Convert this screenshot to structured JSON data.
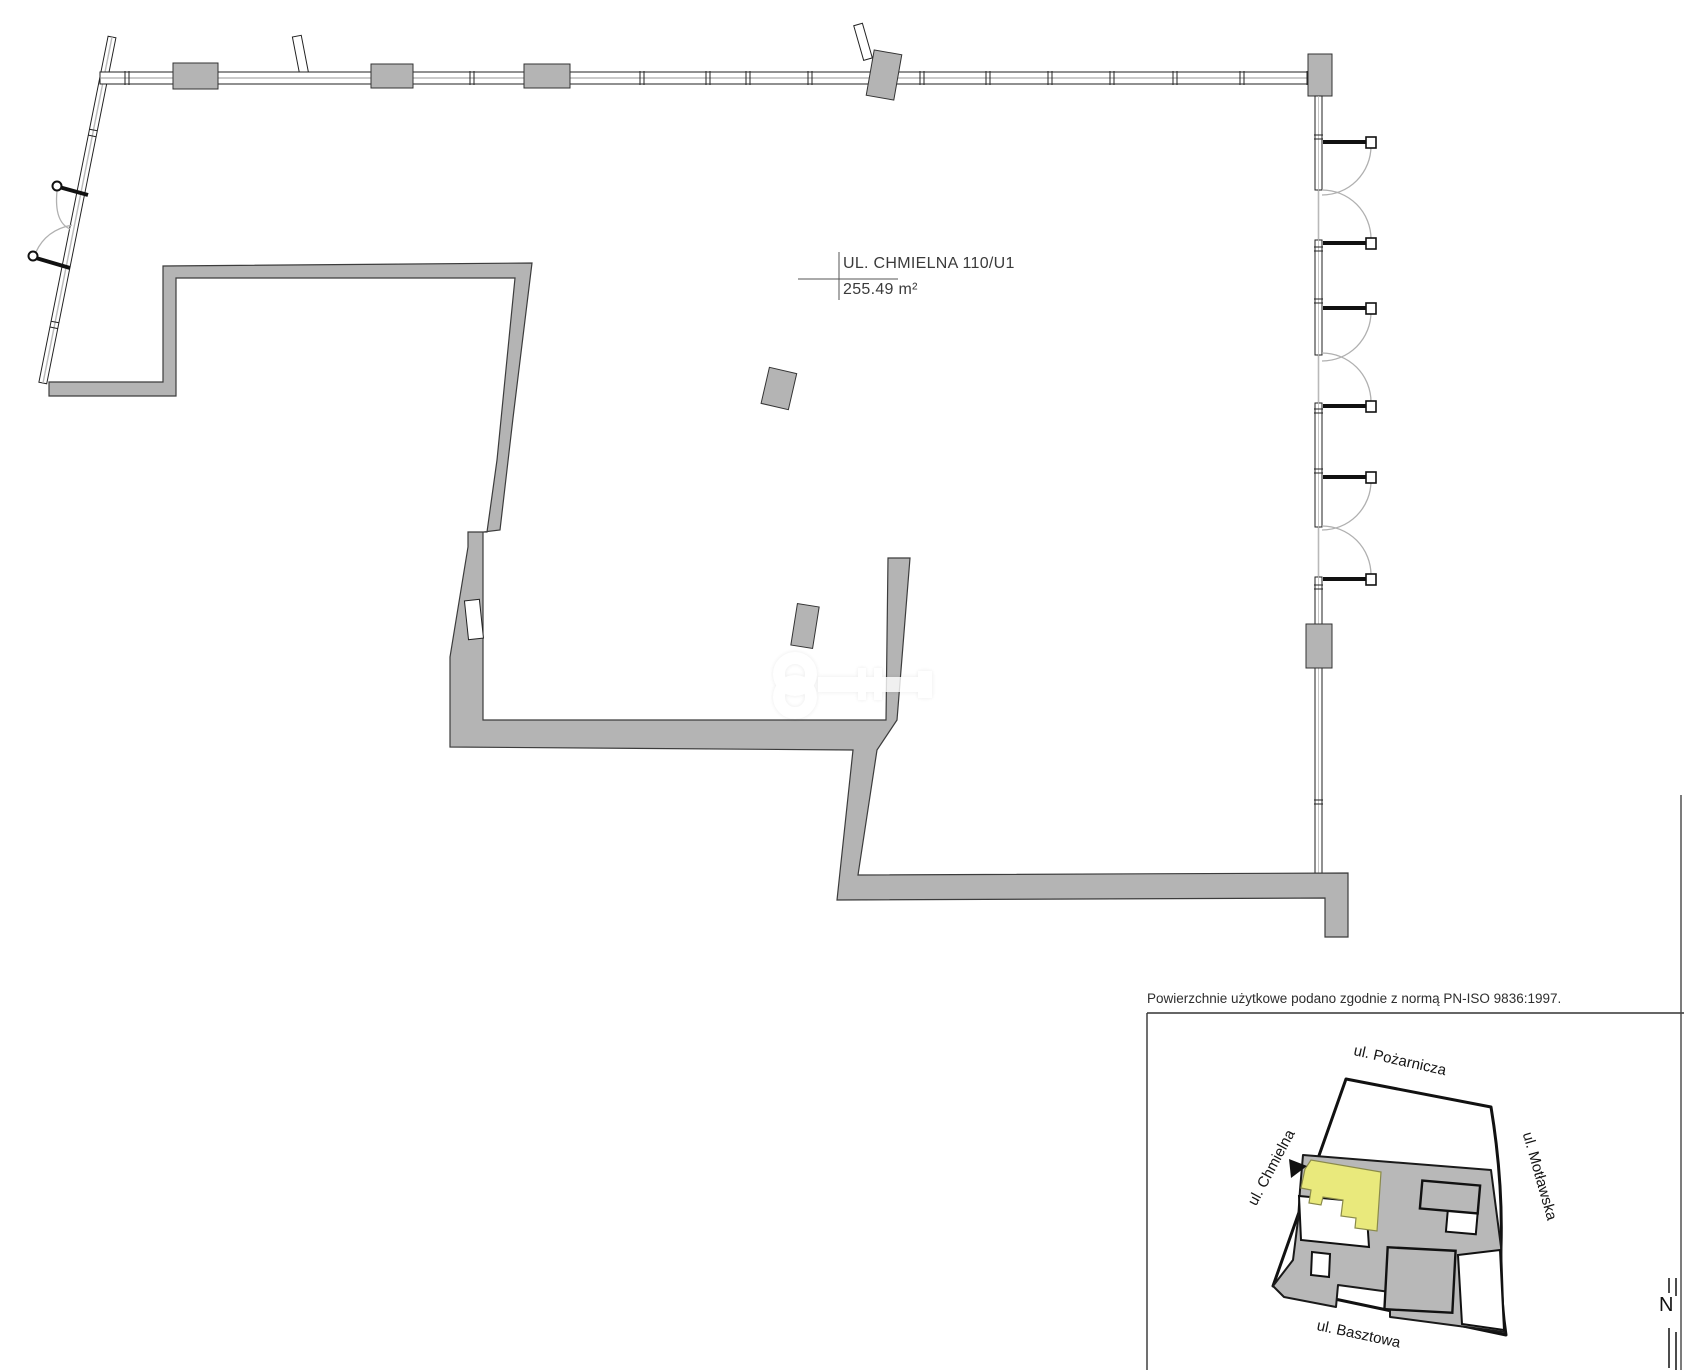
{
  "plan": {
    "unit_label": "UL. CHMIELNA 110/U1",
    "unit_area": "255.49 m²"
  },
  "footer": {
    "norm_note": "Powierzchnie użytkowe podano zgodnie z normą PN-ISO 9836:1997."
  },
  "map": {
    "streets": {
      "top": "ul. Pożarnicza",
      "left": "ul. Chmielna",
      "right": "ul. Motławska",
      "bottom": "ul. Basztowa"
    },
    "highlight_color": "#e9e97c",
    "building_color": "#b8b8b8"
  },
  "compass": {
    "north_label": "N"
  },
  "colors": {
    "wall_fill": "#b4b4b4",
    "wall_outline": "#3c3c3c",
    "door_arc": "#b0b0b0",
    "text": "#3b3b3b"
  }
}
